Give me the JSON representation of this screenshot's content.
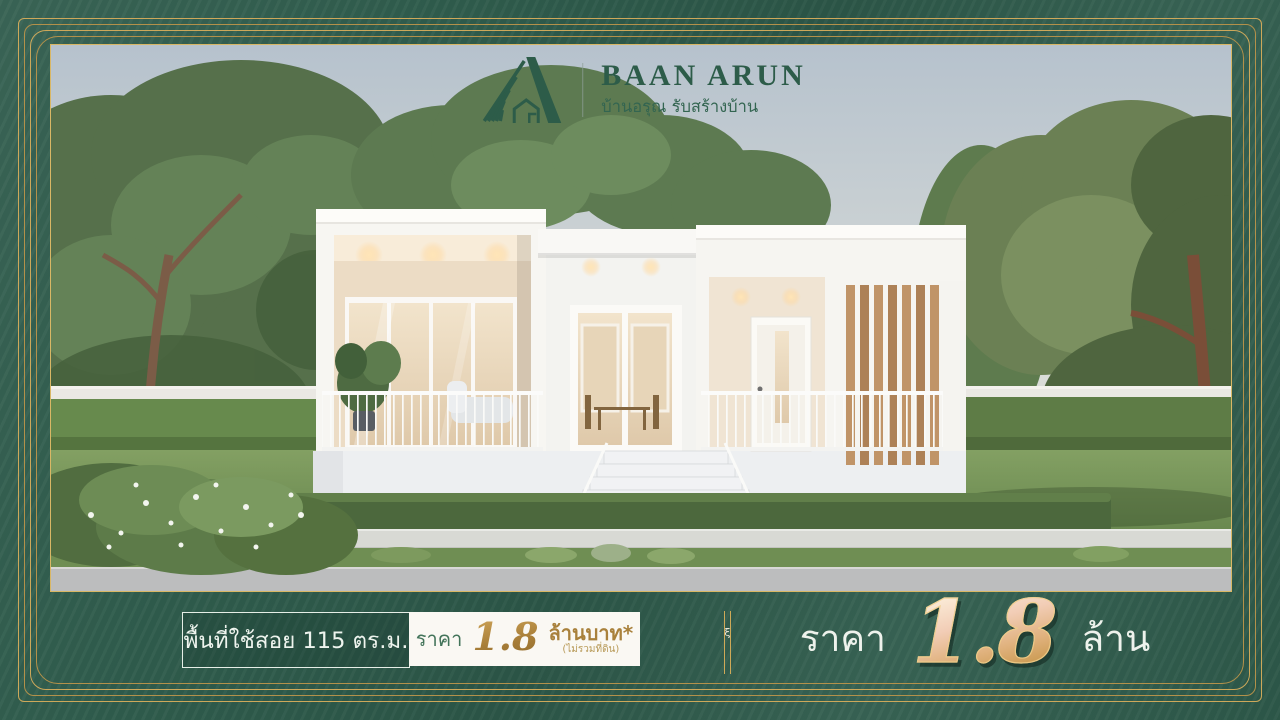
{
  "brand": {
    "name": "BAAN ARUN",
    "tagline": "บ้านอรุณ รับสร้างบ้าน",
    "logo_icon": "sunrise-house-logo"
  },
  "info_bar": {
    "area_text": "พื้นที่ใช้สอย 115 ตร.ม.",
    "price_label": "ราคา",
    "price_value": "1.8",
    "price_unit": "ล้านบาท*",
    "price_note": "(ไม่รวมที่ดิน)",
    "divider_ornament": "ξ"
  },
  "price_banner": {
    "label": "ราคา",
    "value": "1.8",
    "unit": "ล้าน"
  },
  "colors": {
    "frame_green": "#2f5c4c",
    "frame_gold": "#c9a452",
    "logo_green": "#2d5c49",
    "price_gold": "#a9813c",
    "text_white": "#eef4ee"
  }
}
